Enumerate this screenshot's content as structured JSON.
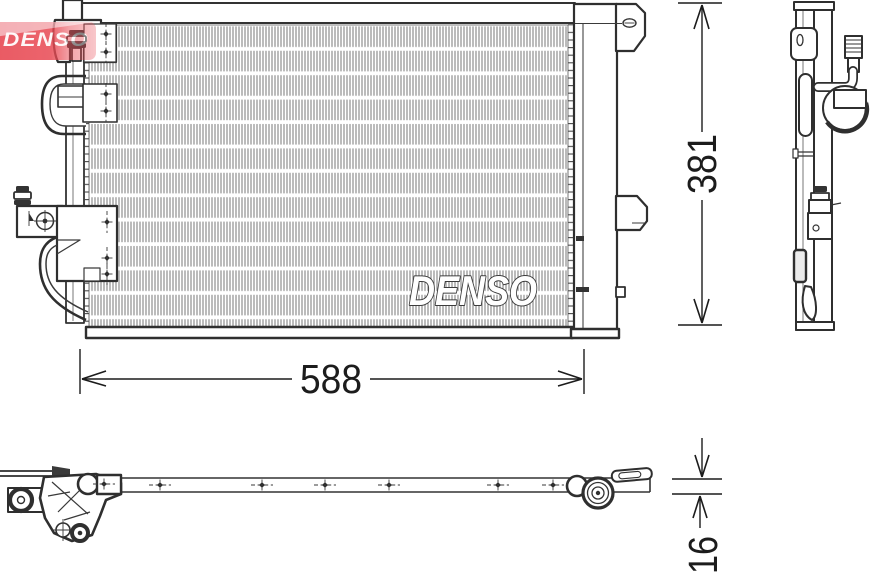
{
  "watermark": {
    "text": "DENSO",
    "band_color": "#e84a54",
    "swoosh_color": "#f3a8ae",
    "text_color": "#ffffff"
  },
  "core_print": {
    "text": "DENSO"
  },
  "dimensions": {
    "width_label": "588",
    "height_label": "381",
    "depth_label": "16"
  },
  "drawing": {
    "background": "#ffffff",
    "line_color": "#2f2f2f",
    "fin_color": "#7d7d7d"
  }
}
